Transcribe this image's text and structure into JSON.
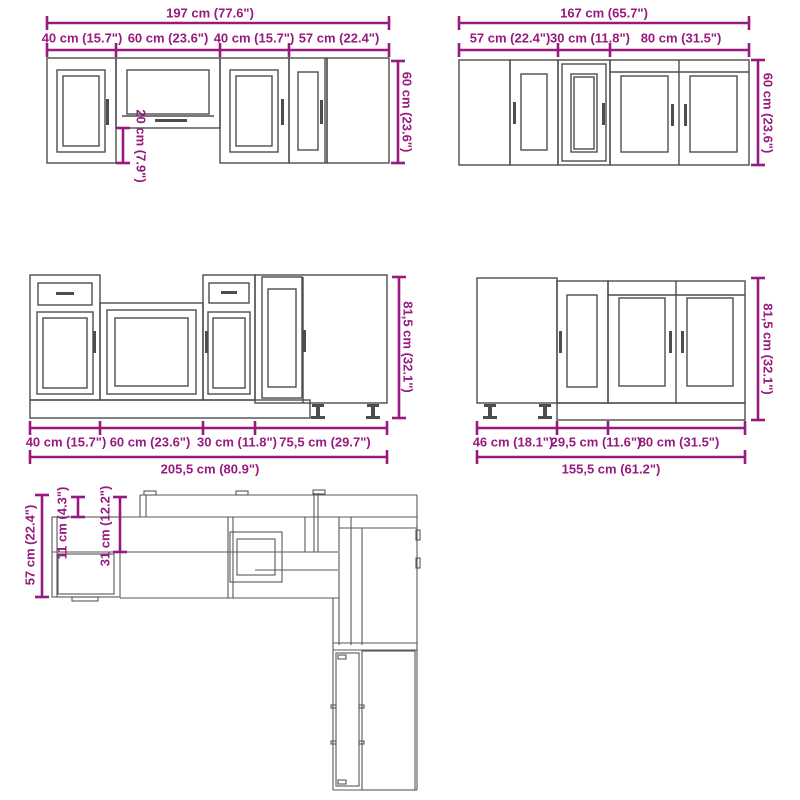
{
  "colors": {
    "dimension_accent": "#971b7e",
    "drawing_line": "#4d4d4d",
    "background": "#ffffff"
  },
  "groups": {
    "wall_run_left": {
      "total": "197 cm (77.6\")",
      "segments": [
        "40 cm (15.7\")",
        "60 cm (23.6\")",
        "40 cm (15.7\")",
        "57 cm (22.4\")"
      ],
      "height": "60 cm (23.6\")",
      "hood_clearance": "20 cm (7.9\")"
    },
    "wall_run_right": {
      "total": "167 cm (65.7\")",
      "segments": [
        "57 cm (22.4\")",
        "30 cm (11.8\")",
        "80 cm (31.5\")"
      ],
      "height": "60 cm (23.6\")"
    },
    "base_run_left": {
      "segments": [
        "40 cm (15.7\")",
        "60 cm (23.6\")",
        "30 cm (11.8\")",
        "75,5 cm (29.7\")"
      ],
      "total": "205,5 cm (80.9\")",
      "height": "81,5 cm (32.1\")"
    },
    "base_run_right": {
      "segments": [
        "46 cm (18.1\")",
        "29,5 cm (11.6\")",
        "80 cm (31.5\")"
      ],
      "total": "155,5 cm (61.2\")",
      "height": "81,5 cm (32.1\")"
    },
    "plan_view": {
      "depth": "57 cm (22.4\")",
      "clearance_small": "11 cm (4.3\")",
      "clearance_large": "31 cm (12.2\")"
    }
  }
}
